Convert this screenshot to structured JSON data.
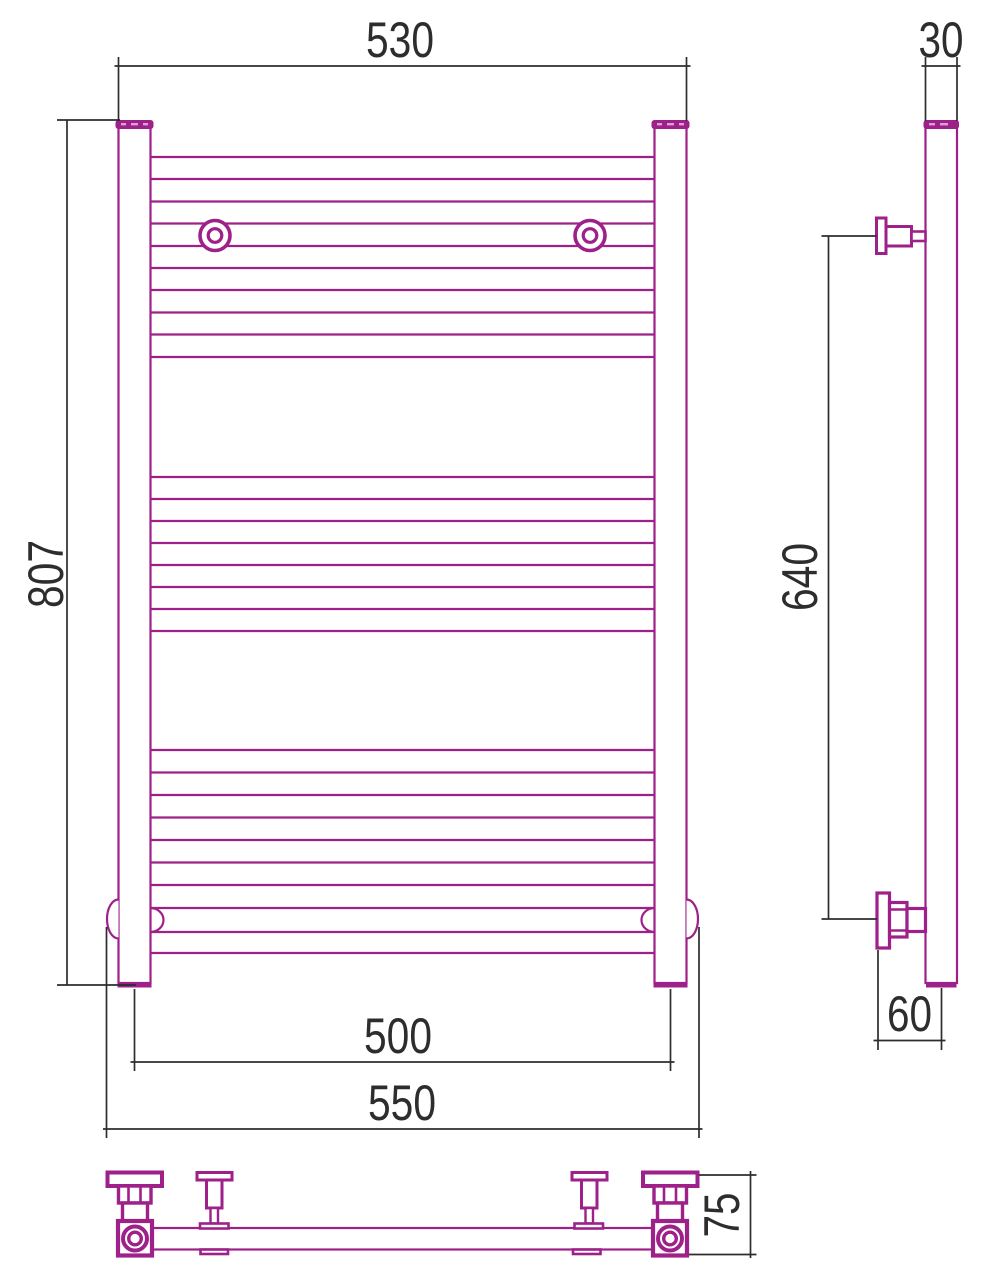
{
  "dims": {
    "front_width_top": "530",
    "front_height": "807",
    "rail_pitch": "500",
    "overall_width": "550",
    "profile_depth": "30",
    "bracket_span": "640",
    "wall_offset": "60",
    "bottom_depth": "75"
  },
  "colors": {
    "outline": "#9e2089",
    "dimension_lines": "#2d2d2d",
    "background": "#ffffff",
    "shape_fill": "#ffffff",
    "cap_hatch": "#d9a0d2"
  },
  "front": {
    "rung_x1": 150,
    "rung_x2": 655,
    "rung_rows_y": [
      157,
      179,
      201.5,
      223.5,
      246,
      268,
      290,
      312.5,
      334.5,
      357,
      477,
      499,
      521,
      543,
      565,
      587,
      609,
      631,
      750,
      772.5,
      795,
      817.5,
      840,
      862.5,
      885,
      953
    ]
  }
}
